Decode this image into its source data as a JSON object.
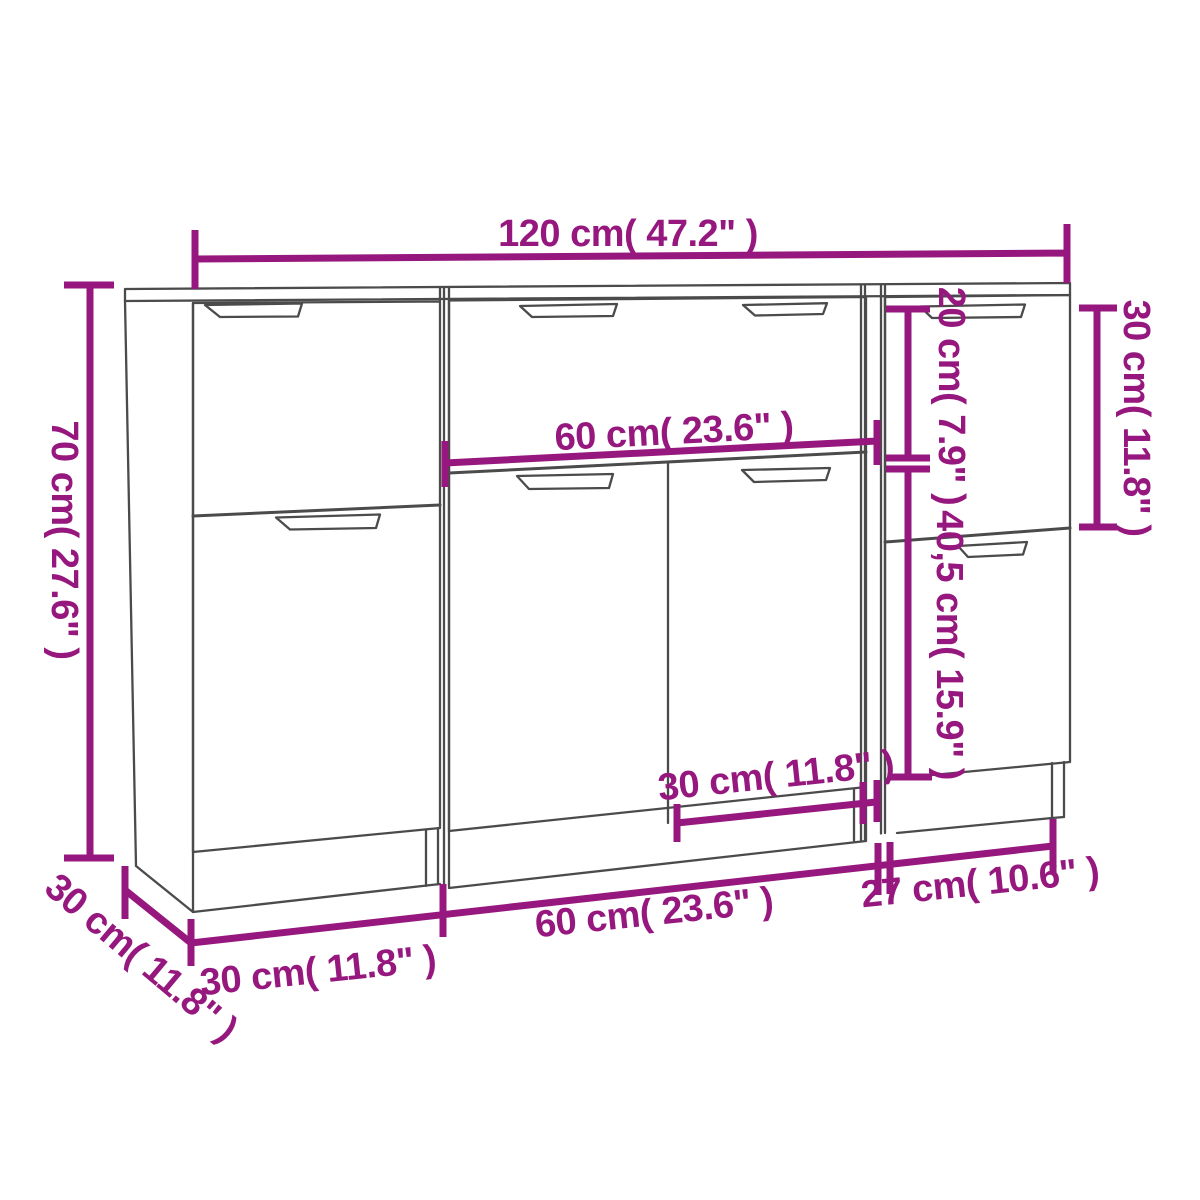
{
  "diagram": {
    "kind": "sideboard-dimension-drawing",
    "units": 3,
    "colors": {
      "dimension_color": "#96187E",
      "outline_color": "#4B4B4B",
      "background": "#FFFFFF"
    },
    "labels": {
      "total_width": "120 cm( 47.2\" )",
      "total_height": "70 cm( 27.6\" )",
      "depth": "30 cm( 11.8\" )",
      "drawer_height": "20 cm( 7.9\" )",
      "right_top_door_height": "30 cm( 11.8\" )",
      "lower_section_height": "40,5 cm( 15.9\" )",
      "top_drawer_width": "60 cm( 23.6\" )",
      "middle_door_width": "30 cm( 11.8\" )",
      "left_unit_width": "30 cm( 11.8\" )",
      "middle_unit_width": "60 cm( 23.6\" )",
      "right_unit_width": "27 cm( 10.6\" )"
    }
  }
}
